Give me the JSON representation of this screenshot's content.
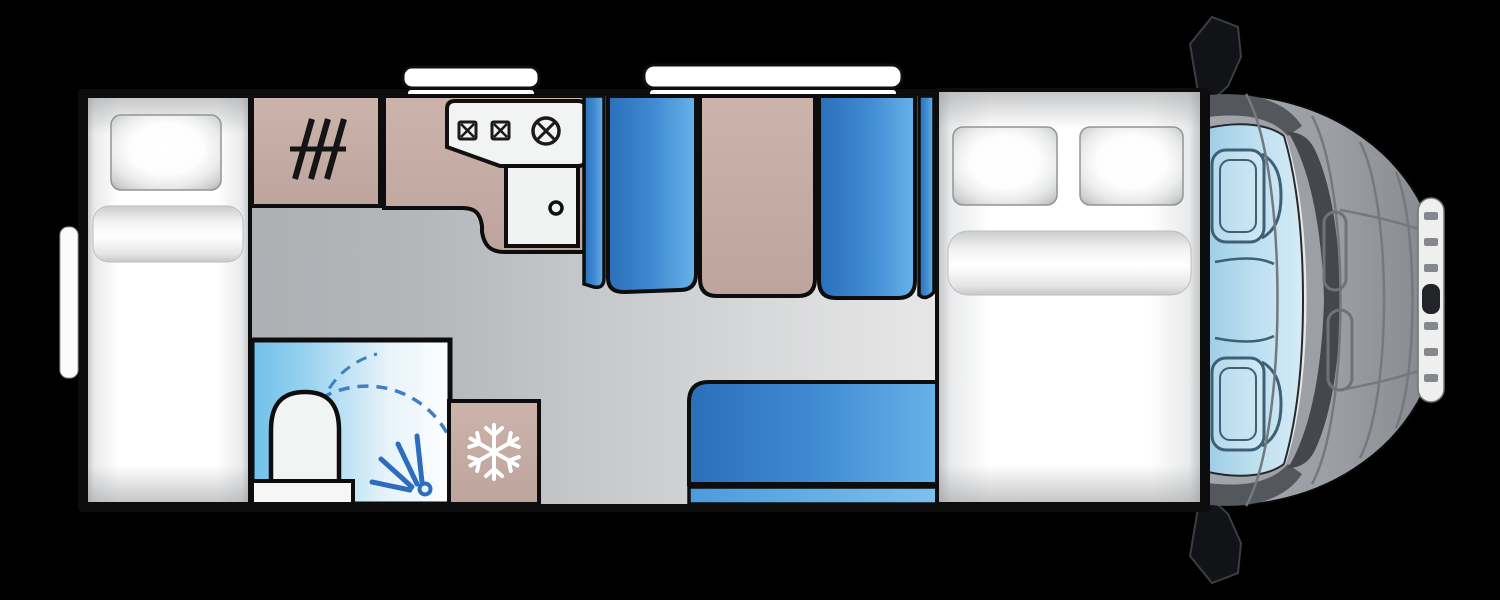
{
  "diagram": {
    "title": "Motorhome floor plan (top view)",
    "canvas": {
      "width": 1500,
      "height": 600,
      "background": "#000000"
    },
    "rooms": [
      {
        "id": "single-bed",
        "label": "Single bed with pillow and duvet"
      },
      {
        "id": "wardrobe",
        "label": "Wardrobe with hanging rail"
      },
      {
        "id": "kitchen",
        "label": "Kitchen worktop"
      },
      {
        "id": "hob",
        "label": "Hob with two small burners and one large burner"
      },
      {
        "id": "sink",
        "label": "Kitchen sink with drain"
      },
      {
        "id": "dinette",
        "label": "Dinette with two facing bench seats and table"
      },
      {
        "id": "washroom",
        "label": "Washroom with shower and toilet"
      },
      {
        "id": "fridge",
        "label": "Refrigerator"
      },
      {
        "id": "sofa",
        "label": "Side sofa bench"
      },
      {
        "id": "double-bed",
        "label": "Double bed with two pillows and duvet"
      }
    ],
    "features": [
      {
        "id": "skylight-kitchen",
        "label": "Roof skylight over kitchen"
      },
      {
        "id": "skylight-dinette",
        "label": "Roof skylight over dinette"
      },
      {
        "id": "entry-door",
        "label": "Entry door marker on left wall"
      },
      {
        "id": "door-swing",
        "label": "Shower door swing arc"
      },
      {
        "id": "shower-spray",
        "label": "Shower spray symbol"
      },
      {
        "id": "snowflake",
        "label": "Fridge snowflake symbol"
      },
      {
        "id": "hanger-rail",
        "label": "Wardrobe rail symbol"
      }
    ],
    "vehicle": {
      "cab_label": "Driver cab (vehicle front, top view)",
      "windscreen_label": "Windscreen with two cab seats",
      "mirror_top_label": "Side mirror",
      "mirror_bottom_label": "Side mirror",
      "grille_label": "Front grille",
      "headlights_label": "Bonnet vents / headlights"
    },
    "palette": {
      "wall": "#0d0d0d",
      "furniture_white": "#f4f4f4",
      "upholstery_blue_dark": "#2b6fb9",
      "upholstery_blue_light": "#66b3ea",
      "wood_tan": "#c6ada5",
      "floor_gray_dark": "#a6a9ad",
      "floor_gray_light": "#f1f1f1",
      "bathroom_blue": "#6fc0ea",
      "icon_blue": "#2d6dbd",
      "cab_gray": "#9b9fa4",
      "windscreen_blue": "#badeef",
      "snowflake_white": "#ffffff"
    }
  }
}
